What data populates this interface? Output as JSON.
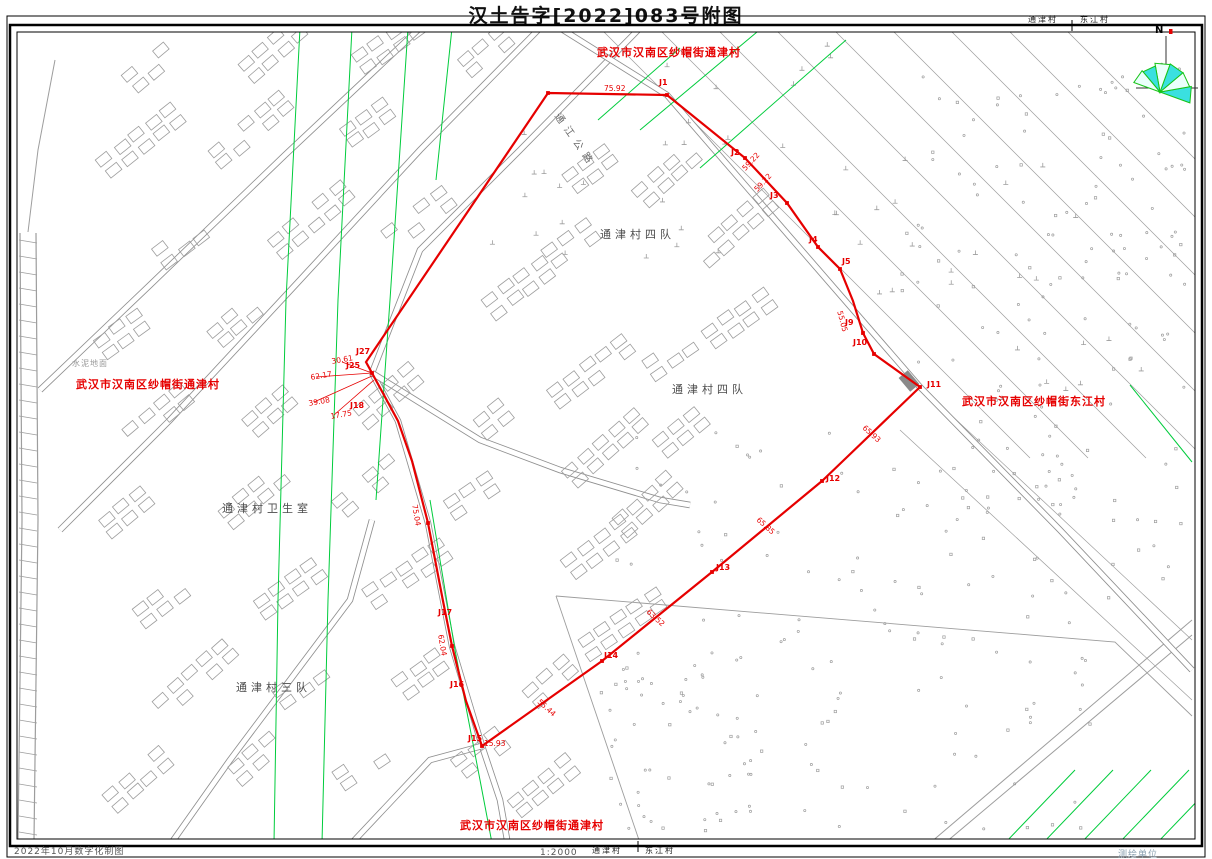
{
  "page": {
    "title": "汉土告字[2022]083号附图"
  },
  "footer": {
    "left": "2022年10月数字化制图",
    "scale": "1:2000",
    "right": "测绘单位"
  },
  "compass": {
    "north_label": "N"
  },
  "colors": {
    "boundary": "#e60000",
    "powerline_green": "#00cc3c",
    "linework_gray": "#9d9d9d",
    "road_gray": "#8f8f8f",
    "compass_cyan": "#3ae0e0",
    "compass_green": "#18c418"
  },
  "boundary_path": [
    [
      548,
      93
    ],
    [
      667,
      95
    ],
    [
      745,
      158
    ],
    [
      787,
      203
    ],
    [
      818,
      247
    ],
    [
      840,
      269
    ],
    [
      853,
      301
    ],
    [
      863,
      333
    ],
    [
      874,
      354
    ],
    [
      920,
      387
    ],
    [
      845,
      459
    ],
    [
      822,
      481
    ],
    [
      712,
      572
    ],
    [
      602,
      661
    ],
    [
      482,
      746
    ],
    [
      466,
      701
    ],
    [
      452,
      646
    ],
    [
      443,
      601
    ],
    [
      428,
      523
    ],
    [
      412,
      461
    ],
    [
      398,
      421
    ],
    [
      372,
      373
    ],
    [
      366,
      362
    ],
    [
      548,
      93
    ]
  ],
  "vertex_markers": [
    [
      667,
      95
    ],
    [
      745,
      158
    ],
    [
      787,
      203
    ],
    [
      818,
      247
    ],
    [
      840,
      269
    ],
    [
      863,
      333
    ],
    [
      874,
      354
    ],
    [
      920,
      387
    ],
    [
      822,
      481
    ],
    [
      712,
      572
    ],
    [
      602,
      661
    ],
    [
      482,
      746
    ],
    [
      452,
      646
    ],
    [
      428,
      523
    ],
    [
      372,
      373
    ],
    [
      548,
      93
    ]
  ],
  "map_labels": [
    {
      "kind": "village",
      "text": "武汉市汉南区纱帽街通津村",
      "x": 597,
      "y": 47,
      "rot": 0
    },
    {
      "kind": "village",
      "text": "武汉市汉南区纱帽街通津村",
      "x": 76,
      "y": 379,
      "rot": 0
    },
    {
      "kind": "village",
      "text": "武汉市汉南区纱帽街东江村",
      "x": 962,
      "y": 396,
      "rot": 0
    },
    {
      "kind": "village",
      "text": "武汉市汉南区纱帽街通津村",
      "x": 460,
      "y": 820,
      "rot": 0
    },
    {
      "kind": "place",
      "text": "通津村四队",
      "x": 600,
      "y": 229,
      "rot": 0
    },
    {
      "kind": "place",
      "text": "通津村四队",
      "x": 672,
      "y": 384,
      "rot": 0
    },
    {
      "kind": "place",
      "text": "通津村卫生室",
      "x": 222,
      "y": 503,
      "rot": 0
    },
    {
      "kind": "place",
      "text": "通津村三队",
      "x": 236,
      "y": 682,
      "rot": 0
    },
    {
      "kind": "small",
      "text": "水泥地面",
      "x": 72,
      "y": 360,
      "rot": 0
    },
    {
      "kind": "road",
      "text": "通江公路",
      "x": 560,
      "y": 112,
      "rot": 55
    },
    {
      "kind": "edge",
      "text": "通津村",
      "x": 1028,
      "y": 16,
      "rot": 0
    },
    {
      "kind": "edge",
      "text": "东江村",
      "x": 1080,
      "y": 16,
      "rot": 0
    },
    {
      "kind": "edge",
      "text": "通津村",
      "x": 592,
      "y": 847,
      "rot": 0
    },
    {
      "kind": "edge",
      "text": "东江村",
      "x": 645,
      "y": 847,
      "rot": 0
    },
    {
      "kind": "jpoint",
      "text": "J1",
      "x": 659,
      "y": 79,
      "rot": 0
    },
    {
      "kind": "jpoint",
      "text": "J2",
      "x": 731,
      "y": 149,
      "rot": 0
    },
    {
      "kind": "jpoint",
      "text": "J3",
      "x": 770,
      "y": 192,
      "rot": 0
    },
    {
      "kind": "jpoint",
      "text": "J4",
      "x": 809,
      "y": 236,
      "rot": 0
    },
    {
      "kind": "jpoint",
      "text": "J5",
      "x": 842,
      "y": 258,
      "rot": 0
    },
    {
      "kind": "jpoint",
      "text": "J9",
      "x": 845,
      "y": 319,
      "rot": 0
    },
    {
      "kind": "jpoint",
      "text": "J10",
      "x": 853,
      "y": 339,
      "rot": 0
    },
    {
      "kind": "jpoint",
      "text": "J11",
      "x": 927,
      "y": 381,
      "rot": 0
    },
    {
      "kind": "jpoint",
      "text": "J12",
      "x": 826,
      "y": 475,
      "rot": 0
    },
    {
      "kind": "jpoint",
      "text": "J13",
      "x": 716,
      "y": 564,
      "rot": 0
    },
    {
      "kind": "jpoint",
      "text": "J14",
      "x": 604,
      "y": 652,
      "rot": 0
    },
    {
      "kind": "jpoint",
      "text": "J15",
      "x": 468,
      "y": 735,
      "rot": 0
    },
    {
      "kind": "jpoint",
      "text": "J16",
      "x": 450,
      "y": 681,
      "rot": 0
    },
    {
      "kind": "jpoint",
      "text": "J17",
      "x": 438,
      "y": 609,
      "rot": 0
    },
    {
      "kind": "jpoint",
      "text": "J18",
      "x": 350,
      "y": 402,
      "rot": 0
    },
    {
      "kind": "jpoint",
      "text": "J25",
      "x": 346,
      "y": 362,
      "rot": 0
    },
    {
      "kind": "jpoint",
      "text": "J27",
      "x": 356,
      "y": 348,
      "rot": 0
    },
    {
      "kind": "dist",
      "text": "75.92",
      "x": 604,
      "y": 85,
      "rot": 0
    },
    {
      "kind": "dist",
      "text": "59.22",
      "x": 741,
      "y": 167,
      "rot": -47
    },
    {
      "kind": "dist",
      "text": "59.22",
      "x": 753,
      "y": 188,
      "rot": -47
    },
    {
      "kind": "dist",
      "text": "55.05",
      "x": 843,
      "y": 310,
      "rot": 75
    },
    {
      "kind": "dist",
      "text": "65.93",
      "x": 866,
      "y": 424,
      "rot": 42
    },
    {
      "kind": "dist",
      "text": "65.85",
      "x": 760,
      "y": 516,
      "rot": 42
    },
    {
      "kind": "dist",
      "text": "63.52",
      "x": 650,
      "y": 608,
      "rot": 42
    },
    {
      "kind": "dist",
      "text": "55.44",
      "x": 541,
      "y": 698,
      "rot": 42
    },
    {
      "kind": "dist",
      "text": "15.93",
      "x": 484,
      "y": 740,
      "rot": 0
    },
    {
      "kind": "dist",
      "text": "62.04",
      "x": 444,
      "y": 634,
      "rot": 80
    },
    {
      "kind": "dist",
      "text": "75.04",
      "x": 418,
      "y": 504,
      "rot": 80
    },
    {
      "kind": "dist",
      "text": "30.61",
      "x": 331,
      "y": 358,
      "rot": -10
    },
    {
      "kind": "dist",
      "text": "62.17",
      "x": 310,
      "y": 374,
      "rot": -10
    },
    {
      "kind": "dist",
      "text": "39.08",
      "x": 308,
      "y": 400,
      "rot": -10
    },
    {
      "kind": "dist",
      "text": "17.75",
      "x": 330,
      "y": 413,
      "rot": -10
    }
  ]
}
